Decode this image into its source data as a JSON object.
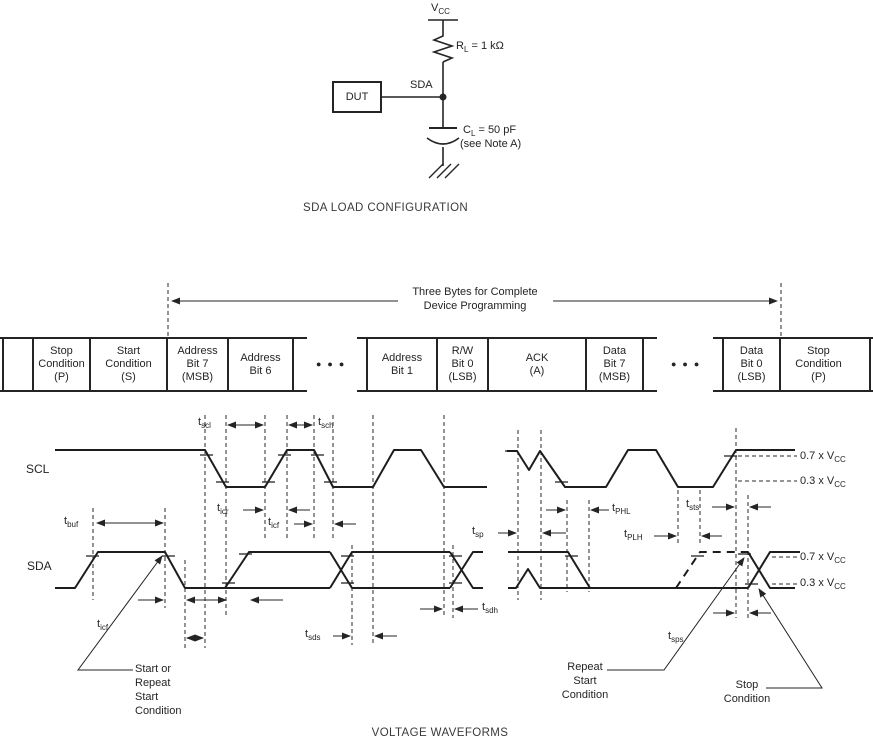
{
  "circuit": {
    "vcc": {
      "base": "V",
      "sub": "CC"
    },
    "resistor": {
      "base": "R",
      "sub": "L",
      "value": " = 1 kΩ"
    },
    "dut_label": "DUT",
    "sda_node_label": "SDA",
    "capacitor": {
      "base": "C",
      "sub": "L",
      "value": " = 50 pF"
    },
    "capacitor_note": "(see Note A)",
    "caption": "SDA LOAD CONFIGURATION"
  },
  "byte_table": {
    "arrow_label": "Three Bytes for Complete\nDevice Programming",
    "ellipsis": "●●●",
    "cells": [
      "Stop\nCondition\n(P)",
      "Start\nCondition\n(S)",
      "Address\nBit 7\n(MSB)",
      "Address\nBit 6",
      "Address\nBit 1",
      "R/W\nBit 0\n(LSB)",
      "ACK\n(A)",
      "Data\nBit 7\n(MSB)",
      "Data\nBit 0\n(LSB)",
      "Stop\nCondition\n(P)"
    ]
  },
  "waveforms": {
    "scl_label": "SCL",
    "sda_label": "SDA",
    "timing": {
      "tbuf": {
        "base": "t",
        "sub": "buf"
      },
      "tscl": {
        "base": "t",
        "sub": "scl"
      },
      "tsch": {
        "base": "t",
        "sub": "sch"
      },
      "ticr": {
        "base": "t",
        "sub": "icr"
      },
      "ticf": {
        "base": "t",
        "sub": "icf"
      },
      "tsds": {
        "base": "t",
        "sub": "sds"
      },
      "tsdh": {
        "base": "t",
        "sub": "sdh"
      },
      "tsp": {
        "base": "t",
        "sub": "sp"
      },
      "tphl": {
        "base": "t",
        "sub": "PHL"
      },
      "tplh": {
        "base": "t",
        "sub": "PLH"
      },
      "tsts": {
        "base": "t",
        "sub": "sts"
      },
      "tsps": {
        "base": "t",
        "sub": "sps"
      }
    },
    "levels": {
      "v07": "0.7 x V",
      "v03": "0.3 x V",
      "sub": "CC"
    },
    "annotations": {
      "start": "Start or\nRepeat\nStart\nCondition",
      "repeat_start": "Repeat\nStart\nCondition",
      "stop": "Stop\nCondition"
    },
    "caption": "VOLTAGE WAVEFORMS"
  }
}
